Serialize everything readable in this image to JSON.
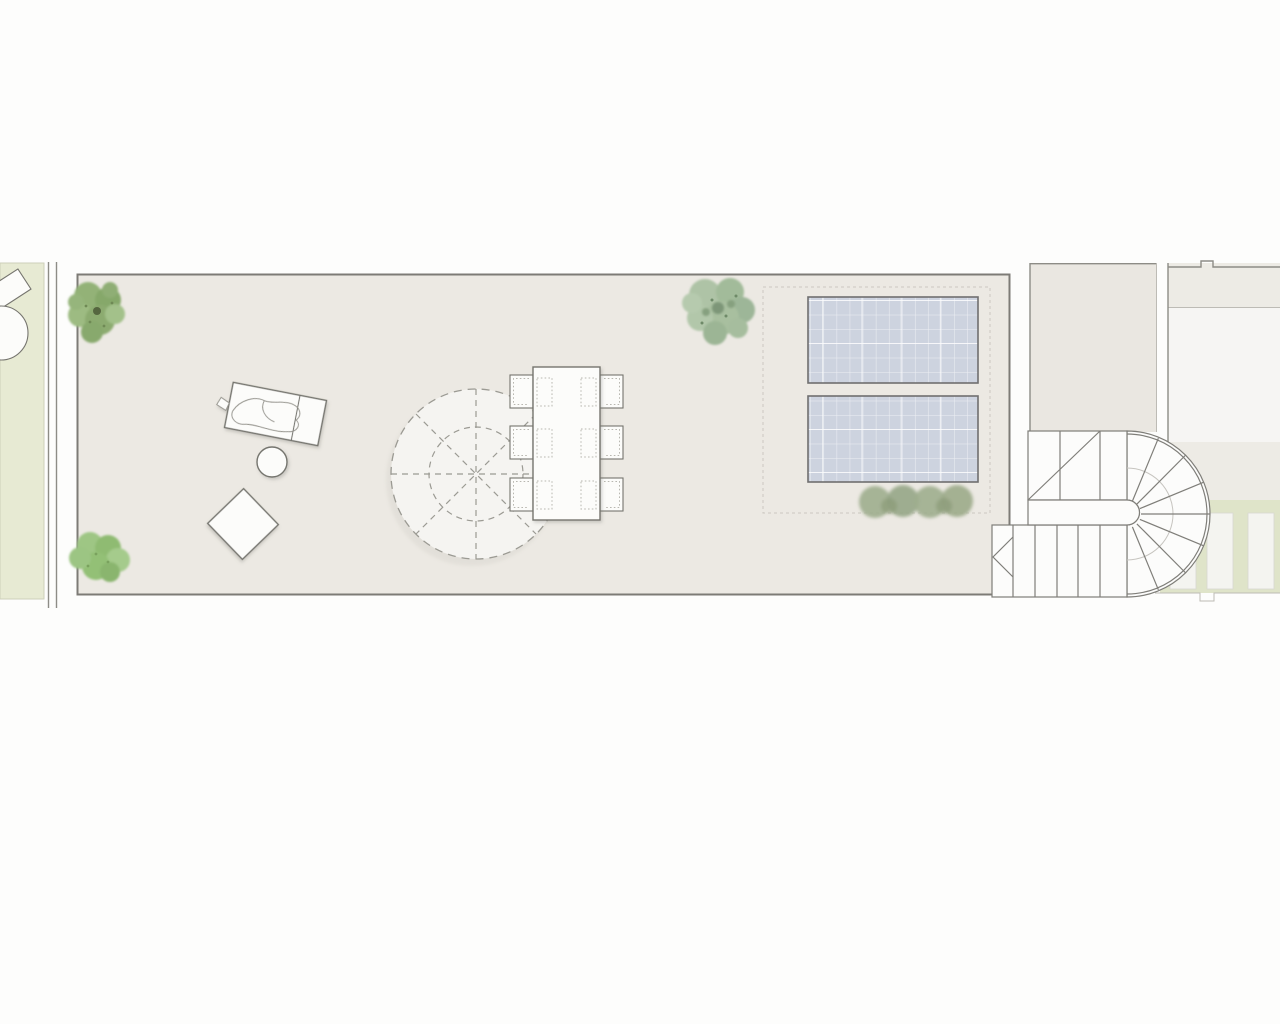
{
  "scene": {
    "kind": "roof-terrace architectural floor plan",
    "orientation": "plan view (top-down)",
    "visible_text": [],
    "description_of_symbols": "elongated roof terrace with lounge furniture, round parasol shown dashed, six-seat dining table, two rooftop solar panels inside a dashed service zone, planting symbols, party walls, neighbouring building volumes and a U-shaped switchback stair with winder treads"
  },
  "inventory": {
    "garden_strip_left": {
      "label": "side garden strip",
      "contains": [
        "partial parasol symbol",
        "partial sun lounger symbol"
      ]
    },
    "party_wall": {
      "label": "double-line party wall"
    },
    "terrace": {
      "label": "main roof terrace deck"
    },
    "planting": [
      {
        "name": "tree-symbol-top-left",
        "count": 1
      },
      {
        "name": "shrub-symbol-bottom-left",
        "count": 1
      },
      {
        "name": "large-plant-symbol-top-center",
        "count": 1
      },
      {
        "name": "hedge-shrub-row",
        "count": 4
      }
    ],
    "furniture": [
      {
        "name": "sun-lounger-with-towel",
        "count": 1
      },
      {
        "name": "round-side-table",
        "count": 1
      },
      {
        "name": "diamond-ottoman",
        "count": 1
      },
      {
        "name": "parasol-dashed-canopy",
        "count": 1
      },
      {
        "name": "dining-table",
        "count": 1
      },
      {
        "name": "dining-chair",
        "count": 6
      }
    ],
    "equipment": [
      {
        "name": "solar-panel",
        "count": 2
      },
      {
        "name": "solar-zone-dashed-boundary",
        "count": 1
      }
    ],
    "stair": {
      "name": "u-shaped-switchback-stair",
      "flights": 2,
      "winder_treads": 8,
      "direction_arrow": "chevron at lower flight start"
    },
    "right_side": {
      "neighbour_block_beige": 1,
      "neighbour_building_white": 1,
      "garden_strip_right": 1,
      "deck_pavers": 3
    }
  },
  "colors": {
    "page_bg": "#fdfdfc",
    "garden_left": "#e7ead3",
    "garden_edge": "#cdd0ba",
    "garden_right": "#dfe4c9",
    "terrace_fill": "#ece9e3",
    "terrace_border": "#7d7b76",
    "wall_line": "#8d8c86",
    "line_light": "#bdbbb5",
    "block_beige": "#eae7e1",
    "building_band": "#edebe5",
    "building_white": "#f6f5f3",
    "furniture_fill": "#fcfcfa",
    "furniture_border": "#75746e",
    "towel_line": "#97968f",
    "umbrella_fill": "#f5f4f1",
    "dash_gray": "#9b9a93",
    "zone_dash": "#cbc8c0",
    "panel_fill": "#cdd3df",
    "panel_border": "#6f6f6f",
    "panel_grid": "#ffffff",
    "stair_fill": "#fcfcfb",
    "stair_line": "#7f7e79",
    "stair_faint": "#c6c4bf",
    "paver_fill": "#f4f4f0",
    "paver_edge": "#d8d8d0",
    "dotted_gray": "#b8b7b0",
    "tree_green_1": "#8fae74",
    "tree_green_2": "#9dbb82",
    "shrub_green": "#94c079",
    "plant_sage": "#a8bf9f",
    "hedge_olive": "#9fae8e",
    "tree_core": "#55663f",
    "shadow": "#6b6a64"
  }
}
